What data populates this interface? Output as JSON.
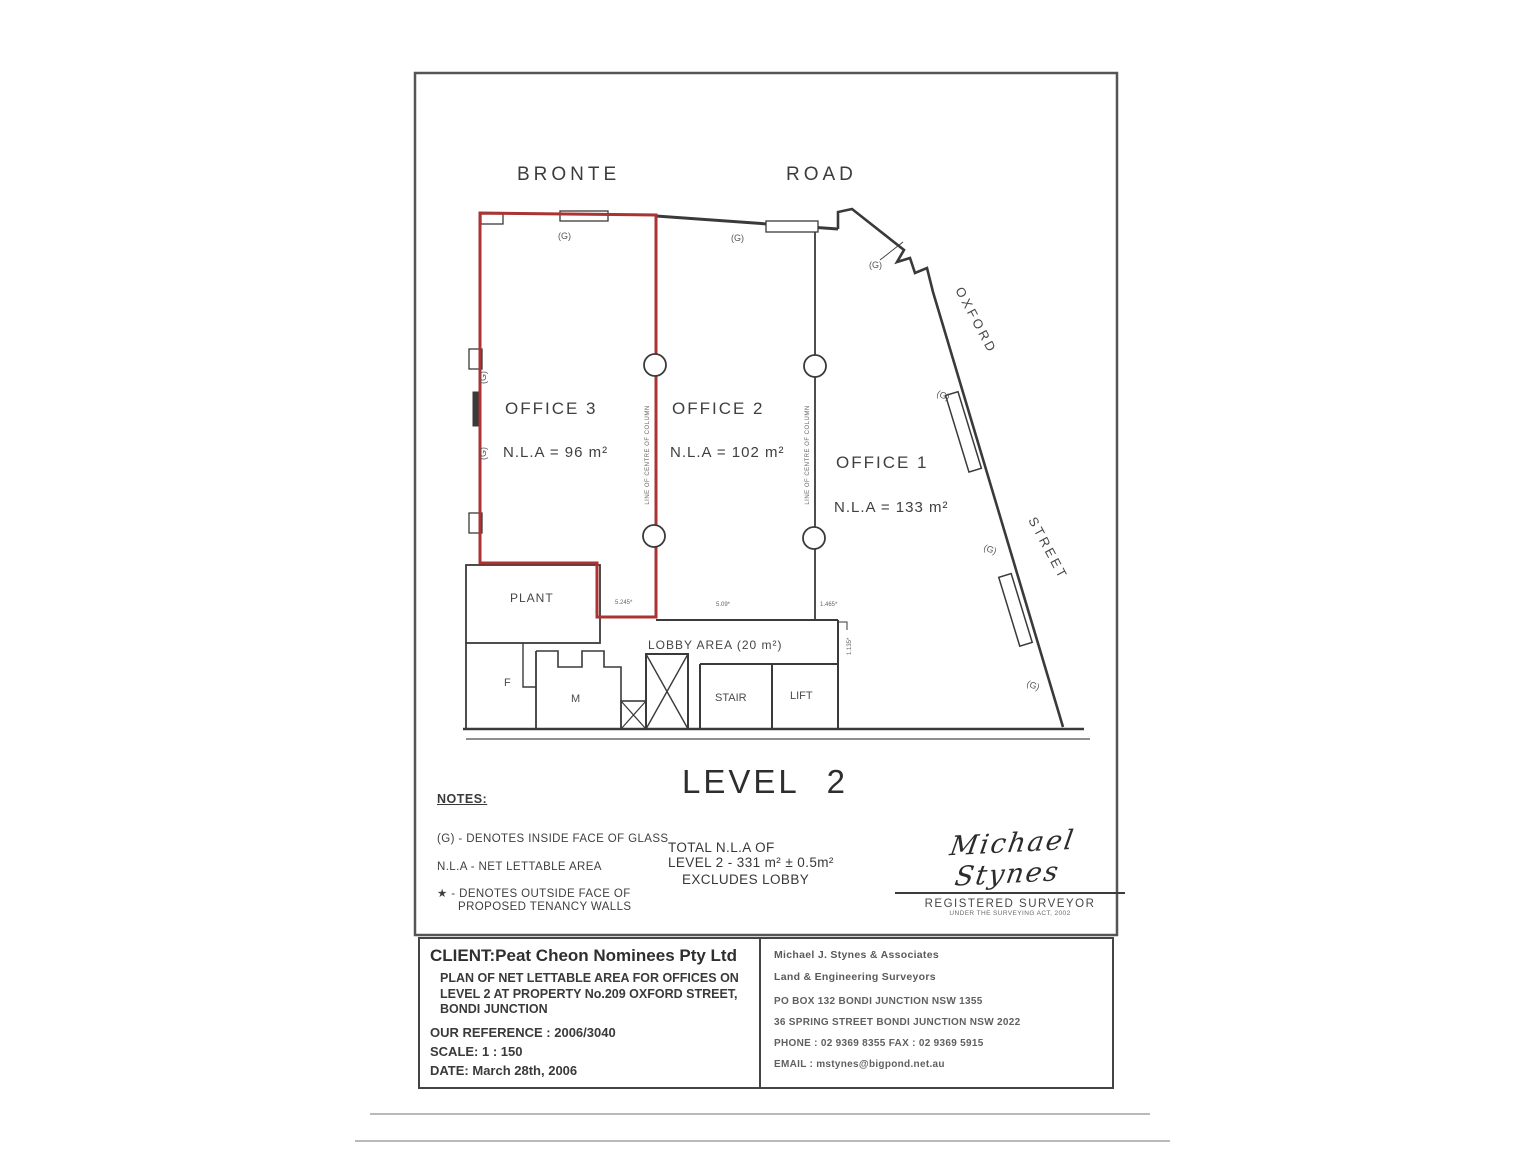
{
  "plan_header": {
    "road_left": "BRONTE",
    "road_right": "ROAD",
    "street_upper": "OXFORD",
    "street_lower": "STREET"
  },
  "offices": {
    "office3": {
      "name": "OFFICE 3",
      "nla": "N.L.A = 96 m²"
    },
    "office2": {
      "name": "OFFICE 2",
      "nla": "N.L.A = 102 m²"
    },
    "office1": {
      "name": "OFFICE 1",
      "nla": "N.L.A = 133 m²"
    }
  },
  "rooms": {
    "plant": "PLANT",
    "lobby": "LOBBY AREA (20 m²)",
    "stair": "STAIR",
    "lift": "LIFT",
    "female": "F",
    "male": "M"
  },
  "annotations": {
    "glass": "(G)",
    "column_line": "LINE OF CENTRE OF COLUMN",
    "dim1": "5.245*",
    "dim2": "5.09*",
    "dim3": "1.465*",
    "dim4": "1.135*"
  },
  "level_title": "LEVEL 2",
  "notes": {
    "heading": "NOTES:",
    "line1": "(G) - DENOTES INSIDE FACE OF GLASS",
    "line2": "N.L.A - NET LETTABLE AREA",
    "line3a": "★ - DENOTES OUTSIDE FACE OF",
    "line3b": "PROPOSED TENANCY WALLS"
  },
  "total": {
    "line1": "TOTAL N.L.A OF",
    "line2": "LEVEL 2 - 331 m² ± 0.5m²",
    "line3": "EXCLUDES LOBBY"
  },
  "signature": {
    "name": "Michael Stynes",
    "title": "REGISTERED SURVEYOR",
    "subtitle": "UNDER THE SURVEYING ACT, 2002"
  },
  "title_block": {
    "client": "CLIENT:Peat Cheon Nominees Pty Ltd",
    "plan_desc_line1": "PLAN OF NET LETTABLE AREA FOR OFFICES ON",
    "plan_desc_line2": "LEVEL 2 AT PROPERTY No.209 OXFORD STREET,",
    "plan_desc_line3": "BONDI JUNCTION",
    "reference": "OUR REFERENCE : 2006/3040",
    "scale": "SCALE: 1 : 150",
    "date": "DATE: March 28th, 2006",
    "firm_line1": "Michael J. Stynes & Associates",
    "firm_line2": "Land & Engineering Surveyors",
    "address_line1": "PO BOX 132 BONDI JUNCTION  NSW  1355",
    "address_line2": "36 SPRING STREET BONDI JUNCTION NSW 2022",
    "phone_fax": "PHONE :  02 9369 8355    FAX :  02 9369 5915",
    "email": "EMAIL :  mstynes@bigpond.net.au"
  }
}
